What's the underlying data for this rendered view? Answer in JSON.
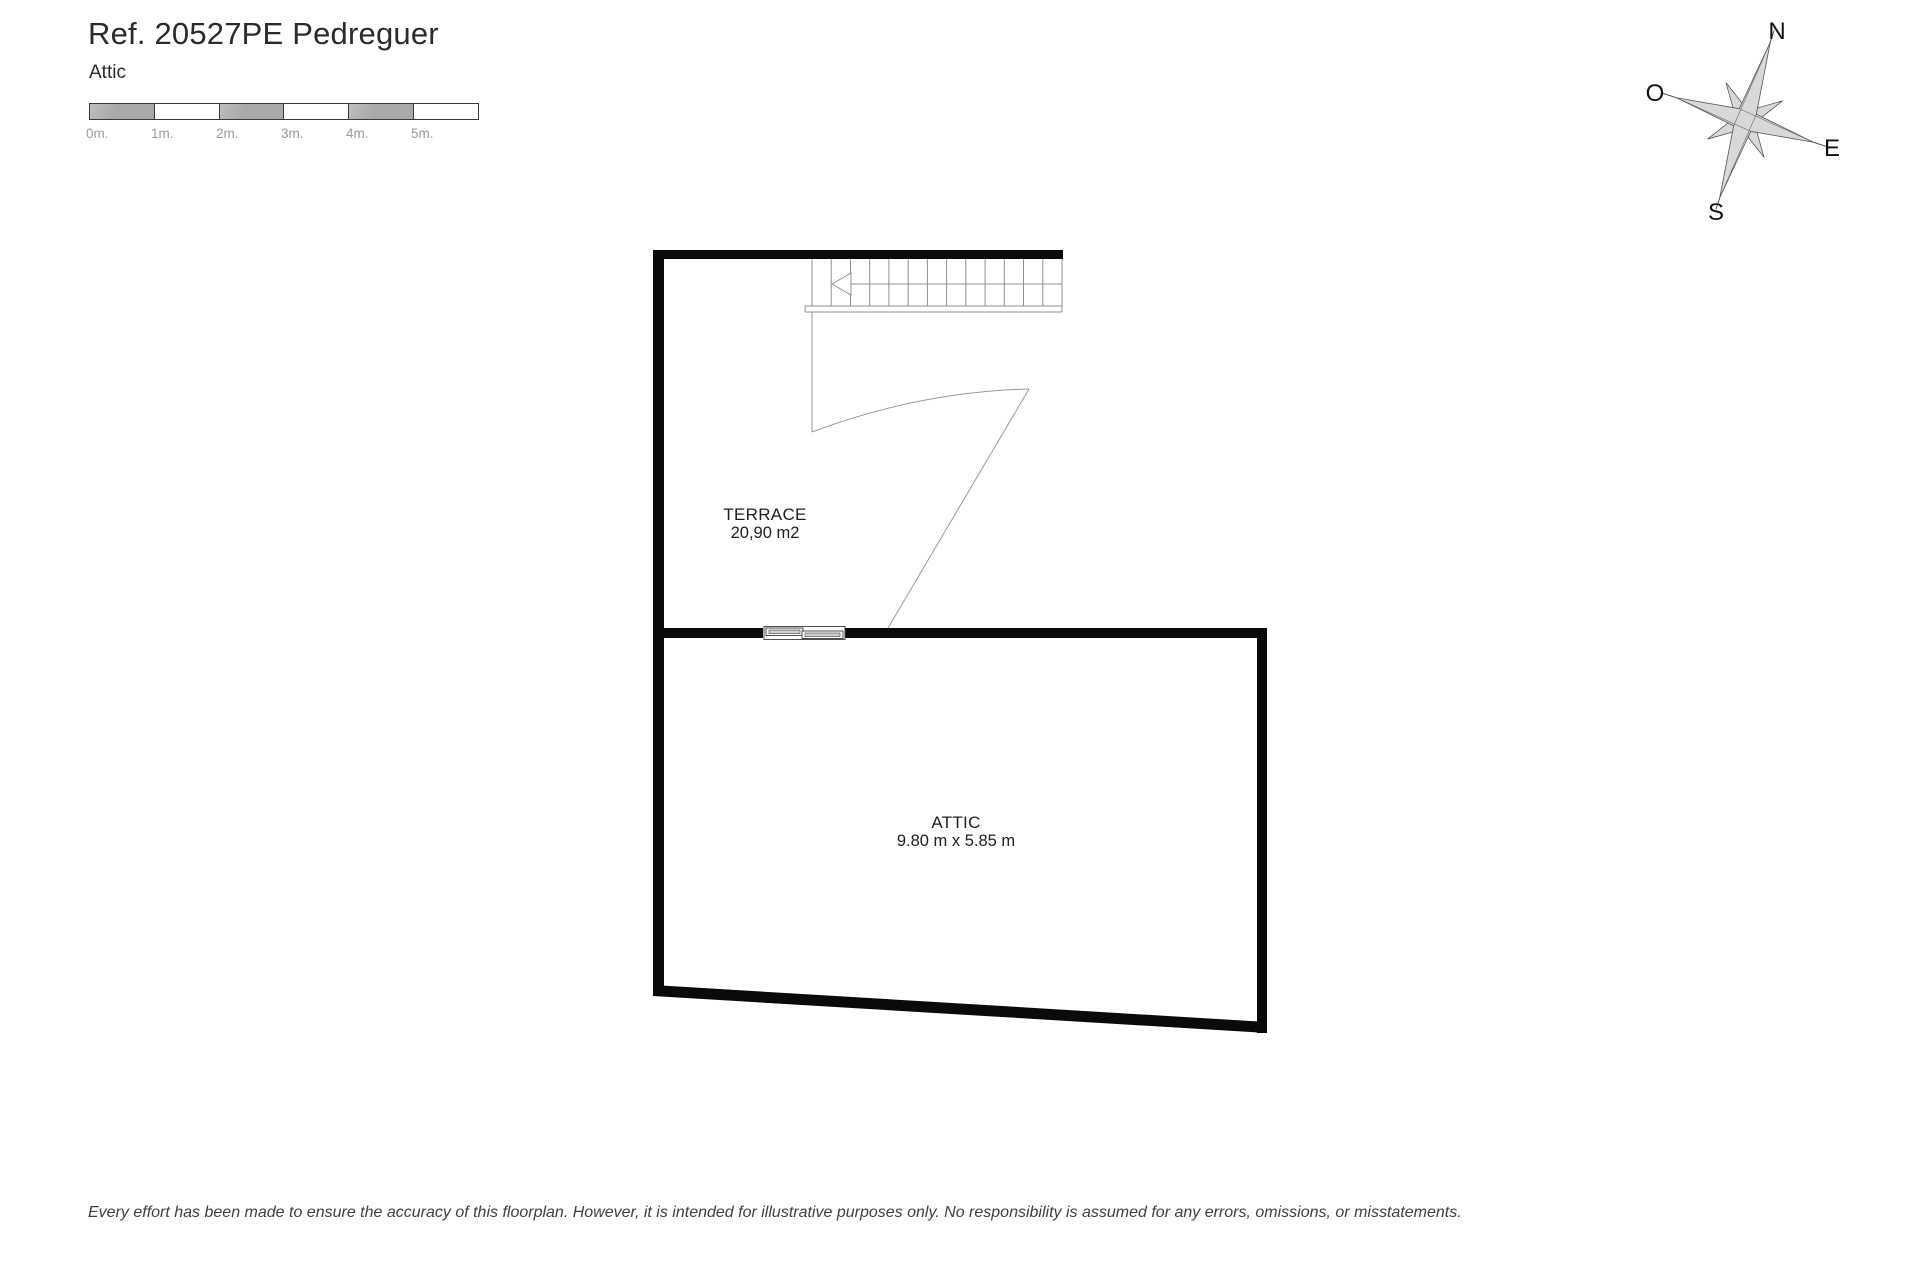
{
  "header": {
    "title": "Ref. 20527PE Pedreguer",
    "subtitle": "Attic"
  },
  "scale_bar": {
    "labels": [
      "0m.",
      "1m.",
      "2m.",
      "3m.",
      "4m.",
      "5m."
    ]
  },
  "compass": {
    "north": "N",
    "west": "O",
    "east": "E",
    "south": "S"
  },
  "floorplan": {
    "terrace": {
      "name": "TERRACE",
      "area": "20,90 m2"
    },
    "attic": {
      "name": "ATTIC",
      "dimensions": "9.80 m x 5.85 m"
    }
  },
  "footer": {
    "disclaimer": "Every effort has been made to ensure the accuracy of this floorplan. However, it is intended for illustrative purposes only. No responsibility is assumed for any errors, omissions, or misstatements."
  },
  "colors": {
    "wall": "#0a0a0a",
    "thin_line": "#8f8f8f",
    "scale_gray": "#a9a9a9",
    "compass_fill": "#d8d8d8"
  }
}
